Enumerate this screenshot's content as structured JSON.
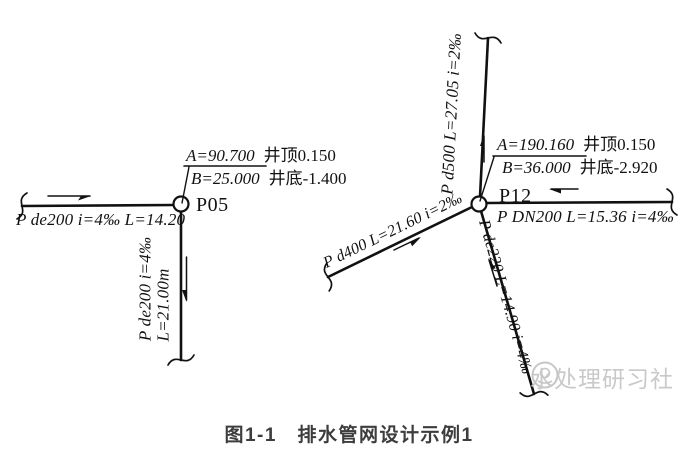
{
  "figure": {
    "caption": "图1-1　排水管网设计示例1"
  },
  "watermark": {
    "text": "水处理研习社"
  },
  "manholes": {
    "p05": {
      "label": "P05",
      "a_value": "A=90.700",
      "a_note": "井顶0.150",
      "b_value": "B=25.000",
      "b_note": "井底-1.400"
    },
    "p12": {
      "label": "P12",
      "a_value": "A=190.160",
      "a_note": "井顶0.150",
      "b_value": "B=36.000",
      "b_note": "井底-2.920"
    }
  },
  "pipes": {
    "inlet_west": "P de200 i=4‰ L=14.20",
    "outlet_south_spec": "P de200 i=4‰",
    "outlet_south_len": "L=21.00m",
    "outlet_north": "P d500 L=27.05 i=2‰",
    "inlet_east": "P DN200 L=15.36 i=4‰",
    "inlet_southwest": "P d400 L=21.60 i=2‰",
    "inlet_southeast": "P de220 L=14.90 i=4‰"
  },
  "colors": {
    "stroke": "#111111",
    "watermark": "#c7c7c7",
    "caption": "#3d3d3d"
  }
}
